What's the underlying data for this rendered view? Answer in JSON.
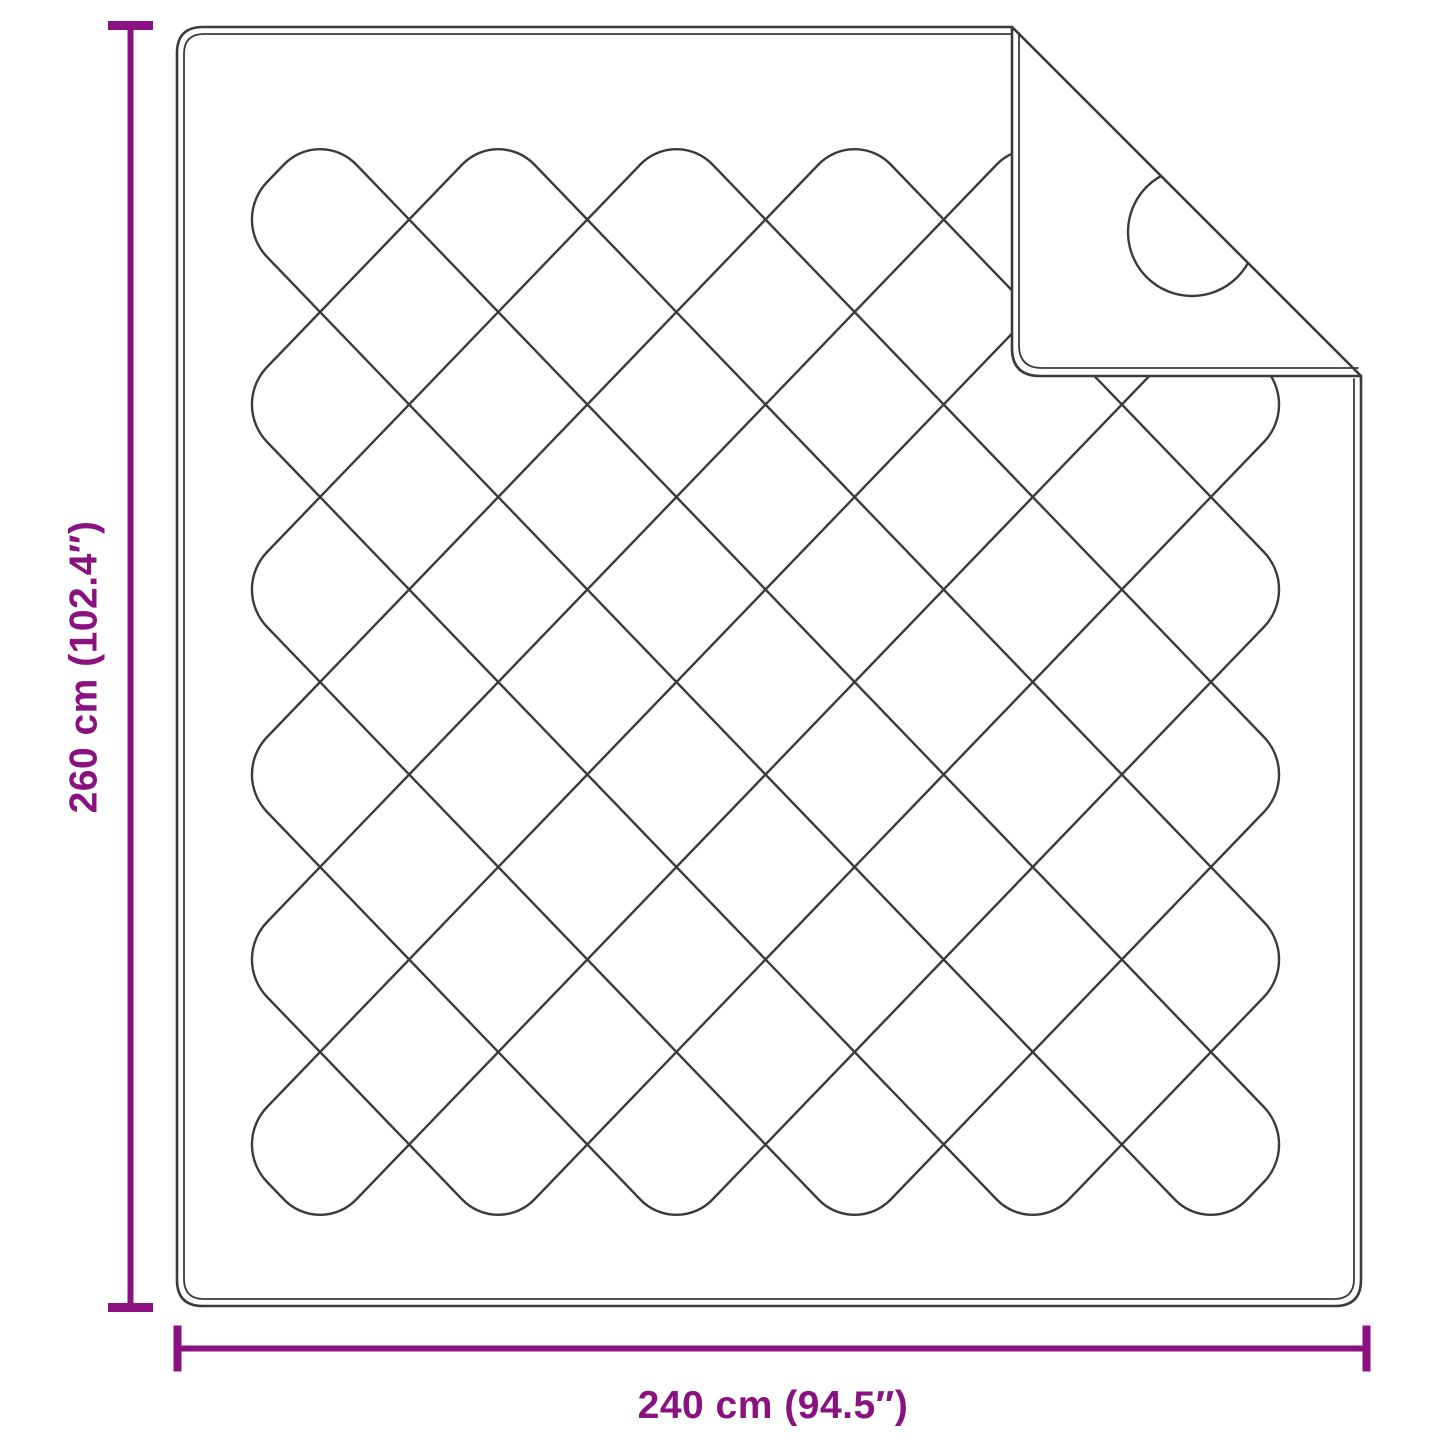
{
  "diagram": {
    "kind": "product-dimension-diagram",
    "subject": "quilted-blanket-top-view-with-folded-corner",
    "dimensions": {
      "height": {
        "label": "260 cm (102.4″)"
      },
      "width": {
        "label": "240 cm (94.5″)"
      }
    },
    "colors": {
      "dimension_accent": "#8A1180",
      "line_dark": "#3b3b3b",
      "line_mid": "#4a4a4a",
      "background": "#ffffff"
    }
  }
}
